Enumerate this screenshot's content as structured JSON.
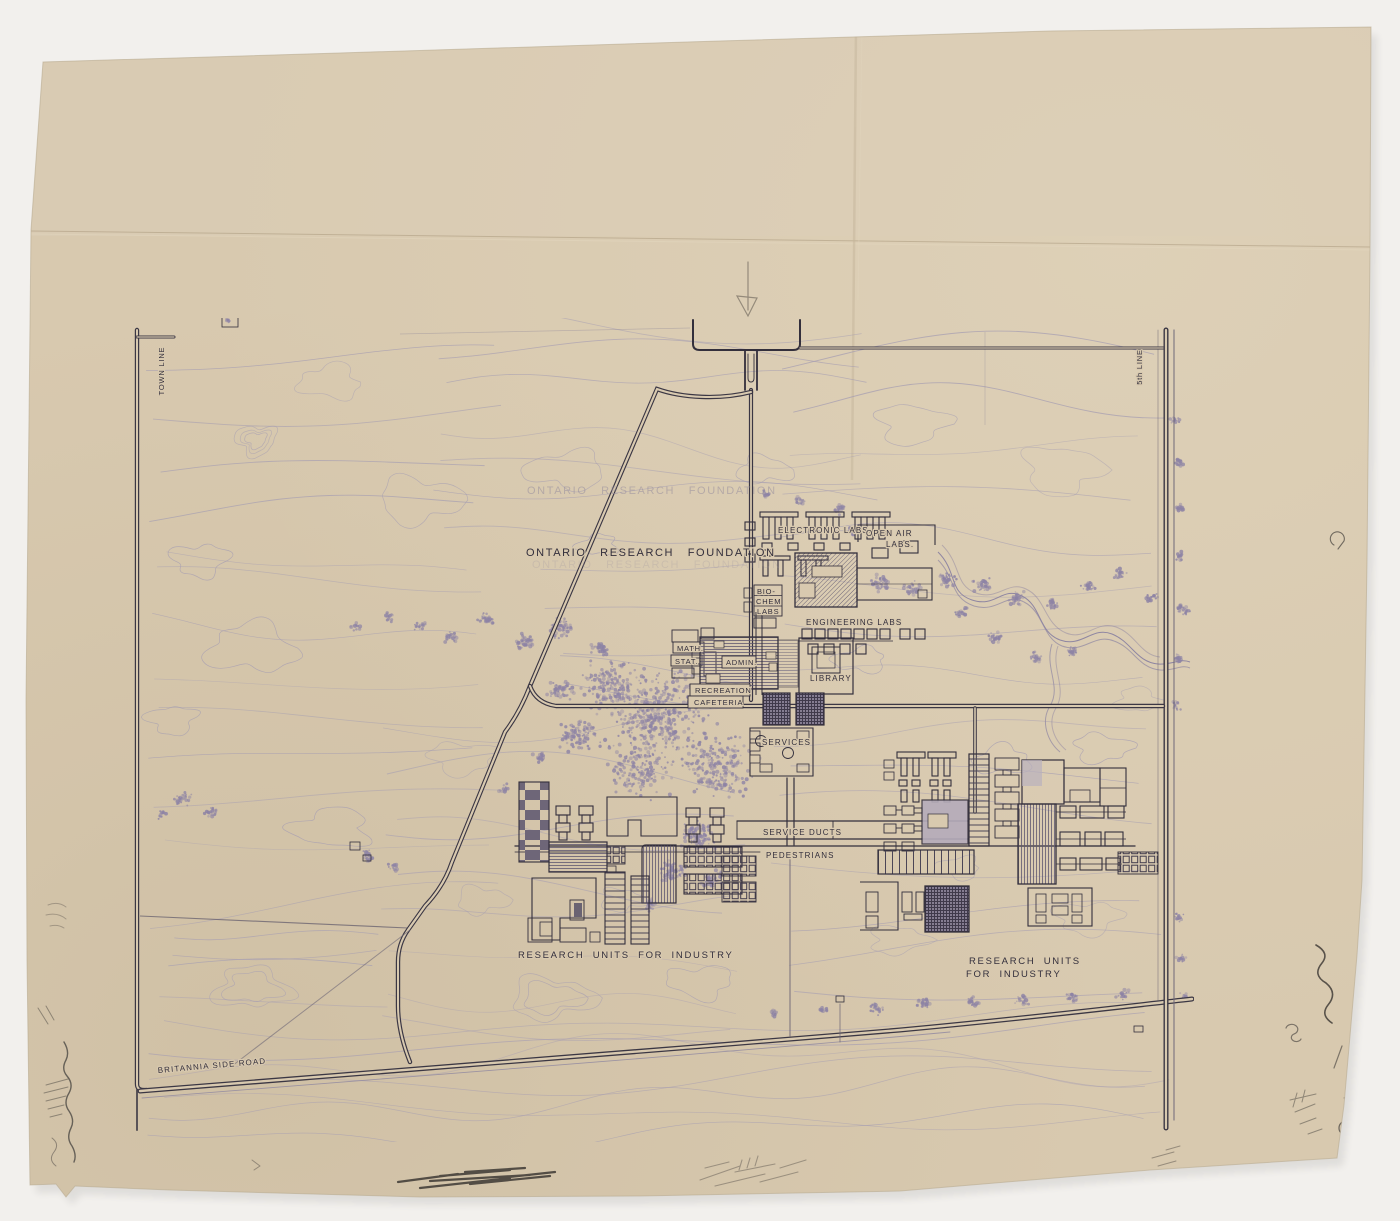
{
  "drawing": {
    "kind": "architectural site plan",
    "title": "ONTARIO RESEARCH FOUNDATION"
  },
  "labels": {
    "town_line": "TOWN LINE",
    "fifth_line": "5th LINE",
    "title": "ONTARIO RESEARCH FOUNDATION",
    "title_ghost": "ONTARIO RESEARCH FOUNDATION",
    "electronic_labs": "ELECTRONIC LABS.",
    "open_air_1": "OPEN AIR",
    "open_air_2": "LABS.",
    "bio_1": "BIO-",
    "bio_2": "CHEM",
    "bio_3": "LABS",
    "engineering_labs": "ENGINEERING LABS",
    "math_1": "MATH.",
    "math_2": "STAT.",
    "admin": "ADMIN.",
    "library": "LIBRARY",
    "rec_1": "RECREATION",
    "rec_2": "CAFETERIA",
    "services": "SERVICES",
    "service_ducts": "SERVICE DUCTS",
    "pedestrians": "PEDESTRIANS",
    "research_left": "RESEARCH UNITS FOR INDUSTRY",
    "research_right_1": "RESEARCH UNITS",
    "research_right_2": "FOR INDUSTRY",
    "britannia": "BRITANNIA SIDE ROAD"
  },
  "colors": {
    "background": "#f2f0ed",
    "paper": "#d8c9af",
    "ink": "#332f3c",
    "road": "#3b3744",
    "contour": "#a59db2",
    "tree": "#8d83a5",
    "pencil": "#55504a",
    "hatch": "#5f5870"
  }
}
